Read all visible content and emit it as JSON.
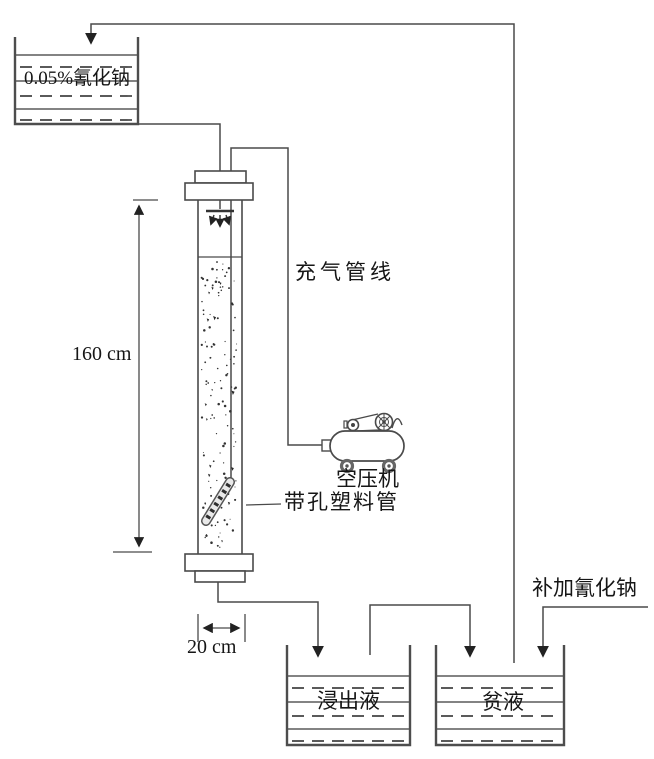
{
  "figure_type": "process-flow-diagram",
  "labels": {
    "nacn_tank": "0.05%氰化钠",
    "aeration_line": "充气管线",
    "column_height": "160 cm",
    "compressor": "空压机",
    "perforated_pipe": "带孔塑料管",
    "makeup_nacn": "补加氰化钠",
    "column_width": "20 cm",
    "leachate_tank": "浸出液",
    "barren_tank": "贫液"
  },
  "colors": {
    "line": "#4a4a4a",
    "liquid_line": "#5a5a5a",
    "arrow": "#222222",
    "text": "#161616",
    "background": "#ffffff"
  }
}
